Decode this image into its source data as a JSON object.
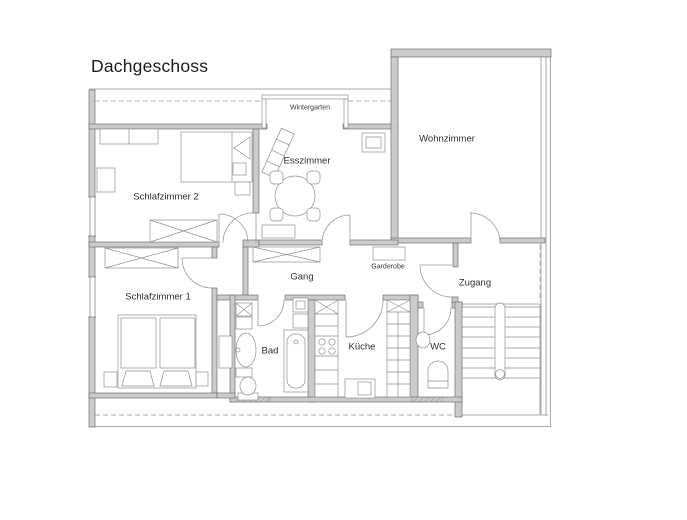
{
  "title": "Dachgeschoss",
  "plan": {
    "rooms": [
      {
        "id": "wintergarten",
        "label": "Wintergarten"
      },
      {
        "id": "esszimmer",
        "label": "Esszimmer"
      },
      {
        "id": "wohnzimmer",
        "label": "Wohnzimmer"
      },
      {
        "id": "schlafzimmer-2",
        "label": "Schlafzimmer 2"
      },
      {
        "id": "schlafzimmer-1",
        "label": "Schlafzimmer 1"
      },
      {
        "id": "gang",
        "label": "Gang"
      },
      {
        "id": "garderobe",
        "label": "Garderobe"
      },
      {
        "id": "zugang",
        "label": "Zugang"
      },
      {
        "id": "bad",
        "label": "Bad"
      },
      {
        "id": "kueche",
        "label": "Küche"
      },
      {
        "id": "wc",
        "label": "WC"
      }
    ],
    "colors": {
      "background": "#ffffff",
      "wall_fill": "#cbcbcb",
      "wall_stroke": "#707070",
      "furniture_stroke": "#8f8f8f",
      "thin_line": "#a8a8a8",
      "text": "#2d2d2d"
    },
    "icons": [
      "double-bed-icon",
      "single-bed-icon",
      "wardrobe-icon",
      "dresser-icon",
      "cabinet-icon",
      "dining-table-icon",
      "chair-icon",
      "lounger-icon",
      "shelf-icon",
      "sideboard-icon",
      "coat-rack-icon",
      "bathtub-icon",
      "sink-icon",
      "toilet-icon",
      "kitchen-counter-icon",
      "stove-icon",
      "dishwasher-icon",
      "stairs-icon",
      "handrail-icon",
      "door-arc-icon",
      "window-icon"
    ]
  }
}
